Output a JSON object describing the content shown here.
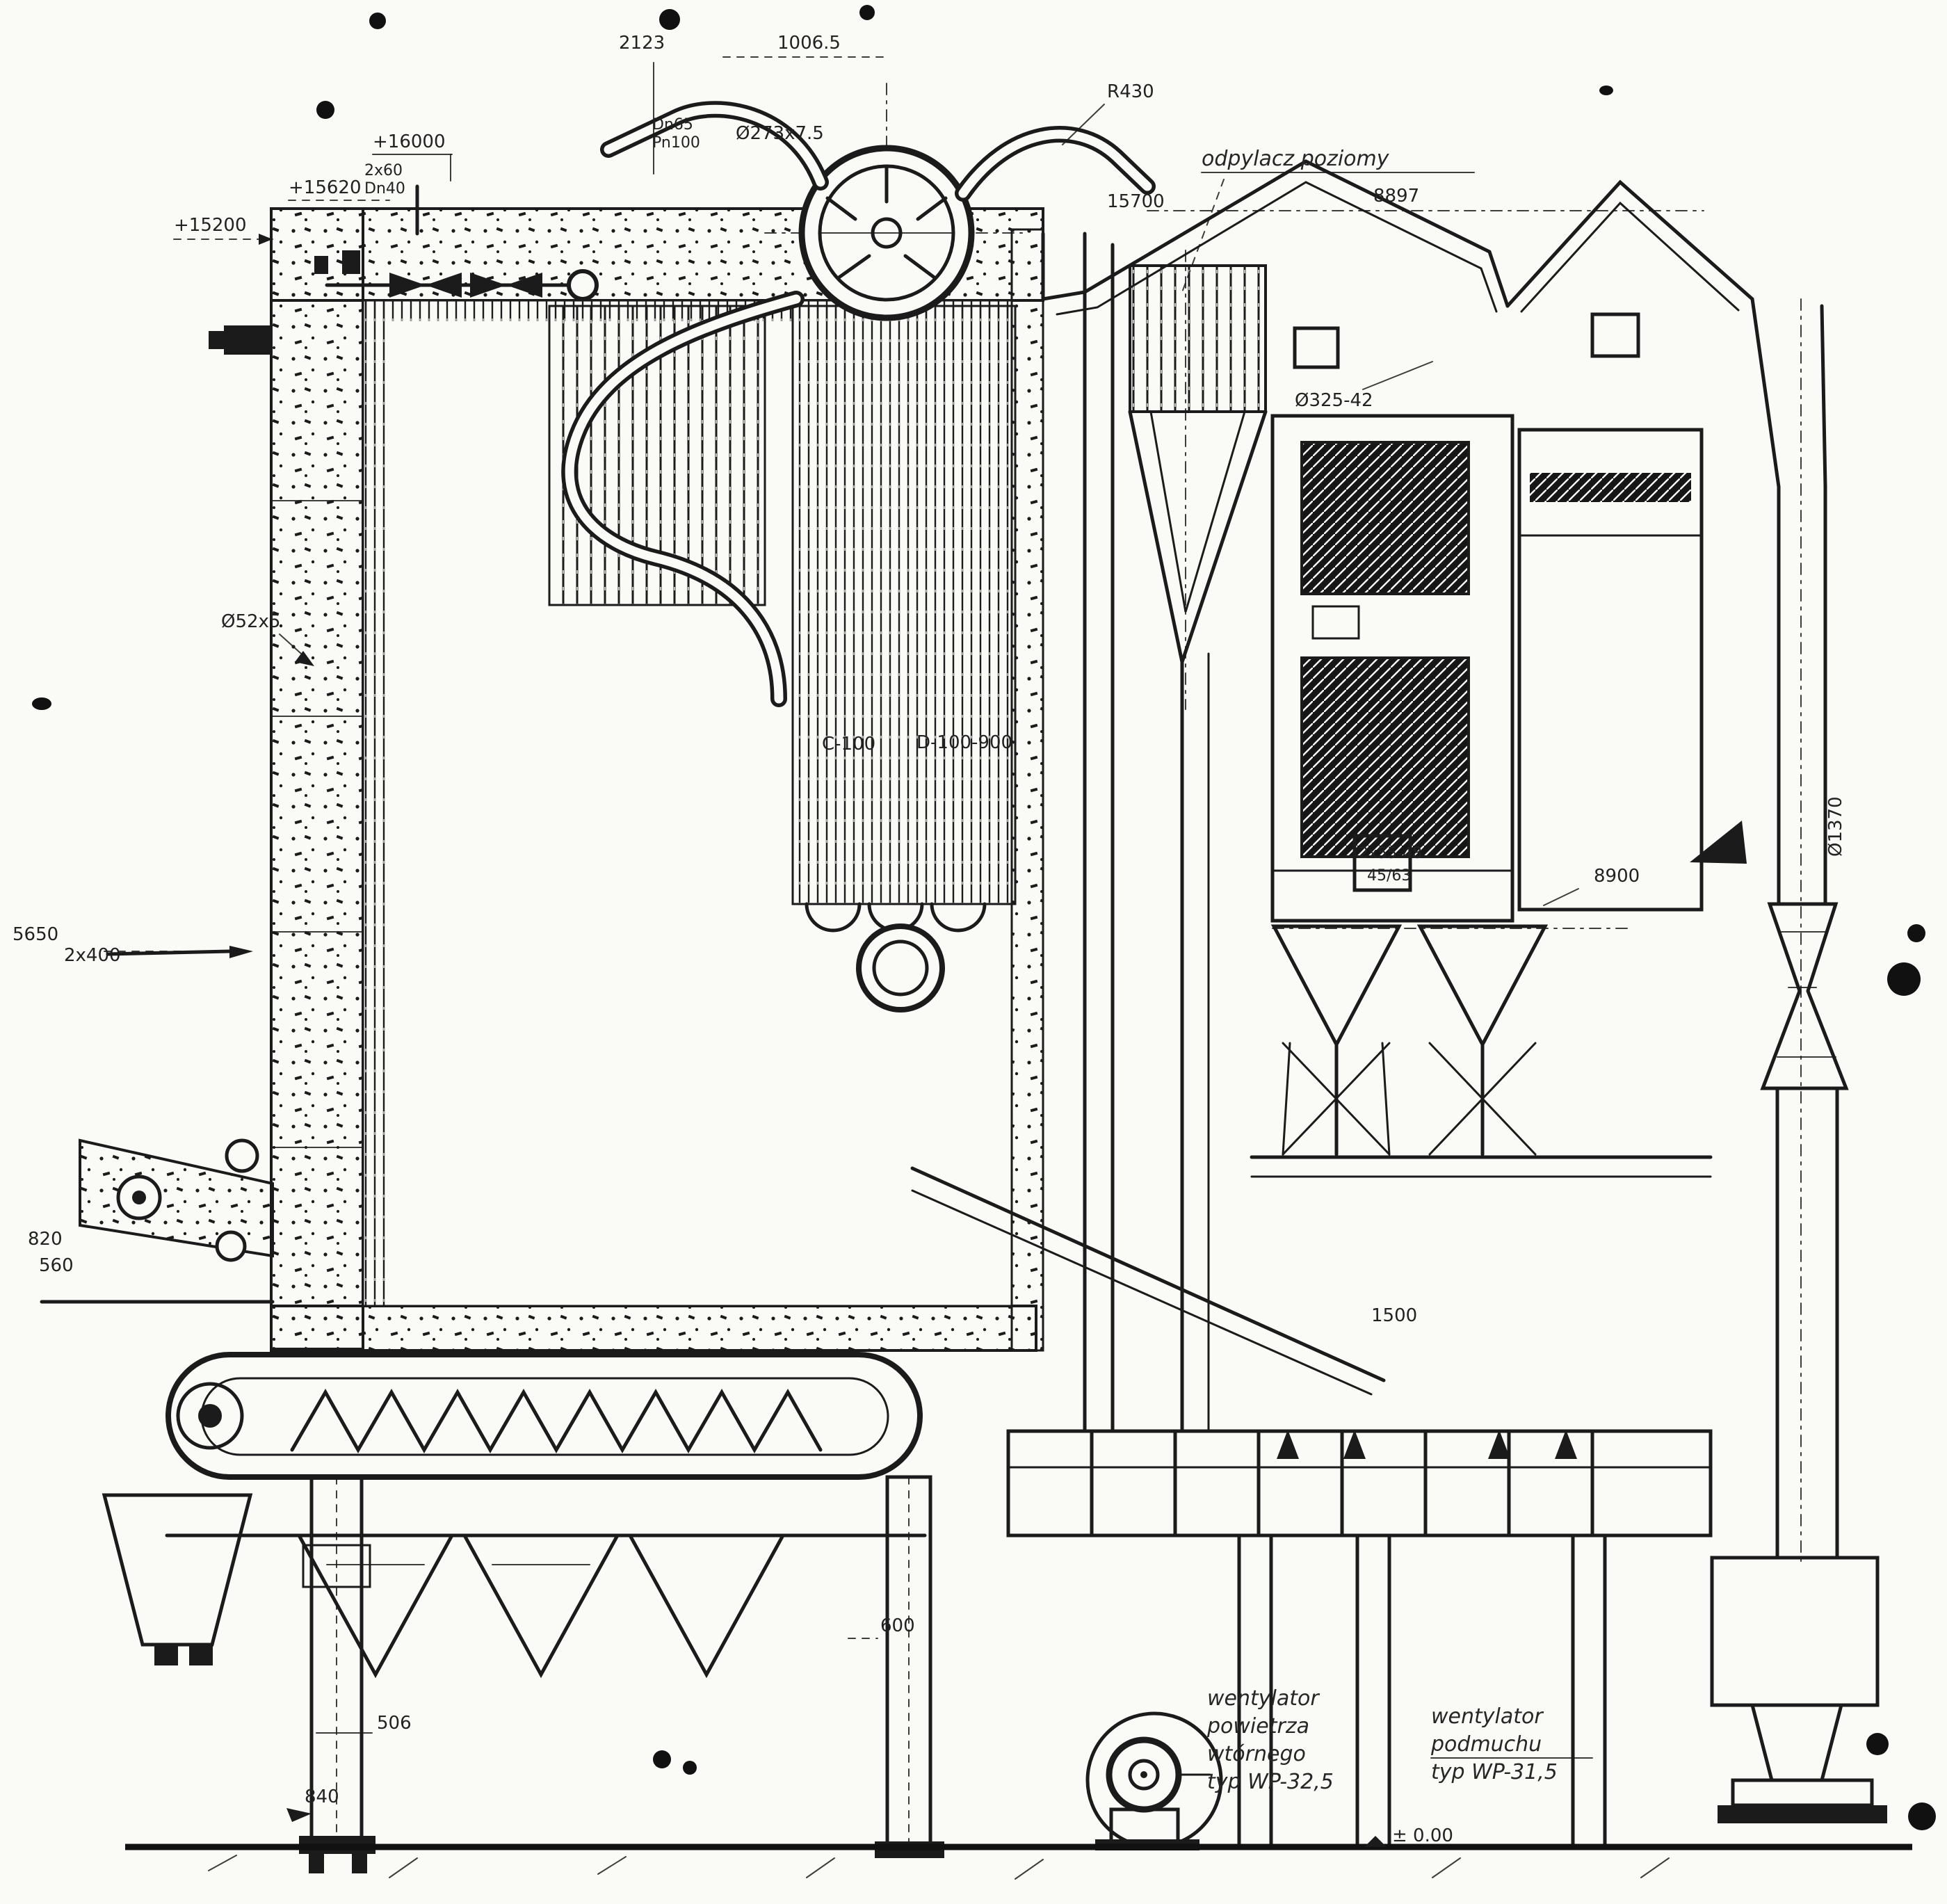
{
  "title": "Przekrój kotła rusztowego — skan rysunku technicznego",
  "colors": {
    "paper": "#fafaf7",
    "ink": "#1b1b1b"
  },
  "elev": {
    "e16000": "+16000",
    "e15620": "+15620",
    "e15200": "+15200",
    "e15700": "15700",
    "e5650": "5650",
    "ground": "± 0.00"
  },
  "dims": {
    "d2123": "2123",
    "d1006_5": "1006.5",
    "d8897": "8897",
    "d8900": "8900",
    "d600": "600",
    "d506": "506",
    "d840": "840",
    "d820": "820",
    "d560": "560",
    "d1500": "1500",
    "d2x400": "2x400"
  },
  "pipes": {
    "p273": "Ø273x7.5",
    "p52": "Ø52x5",
    "p325": "Ø325-42",
    "p1370": "Ø1370",
    "dn1": "Dn65",
    "dn2": "Pn100",
    "riser1": "2x60",
    "riser2": "Dn40",
    "r430": "R430",
    "c100": "C-100",
    "d100": "D-100-900",
    "box1": "2x55-48",
    "box2": "45/63"
  },
  "notes": {
    "dust": "odpylacz poziomy",
    "fanL": [
      "wentylator",
      "powietrza",
      "wtórnego",
      "typ WP-32,5"
    ],
    "fanR": [
      "wentylator",
      "podmuchu",
      "typ WP-31,5"
    ]
  }
}
